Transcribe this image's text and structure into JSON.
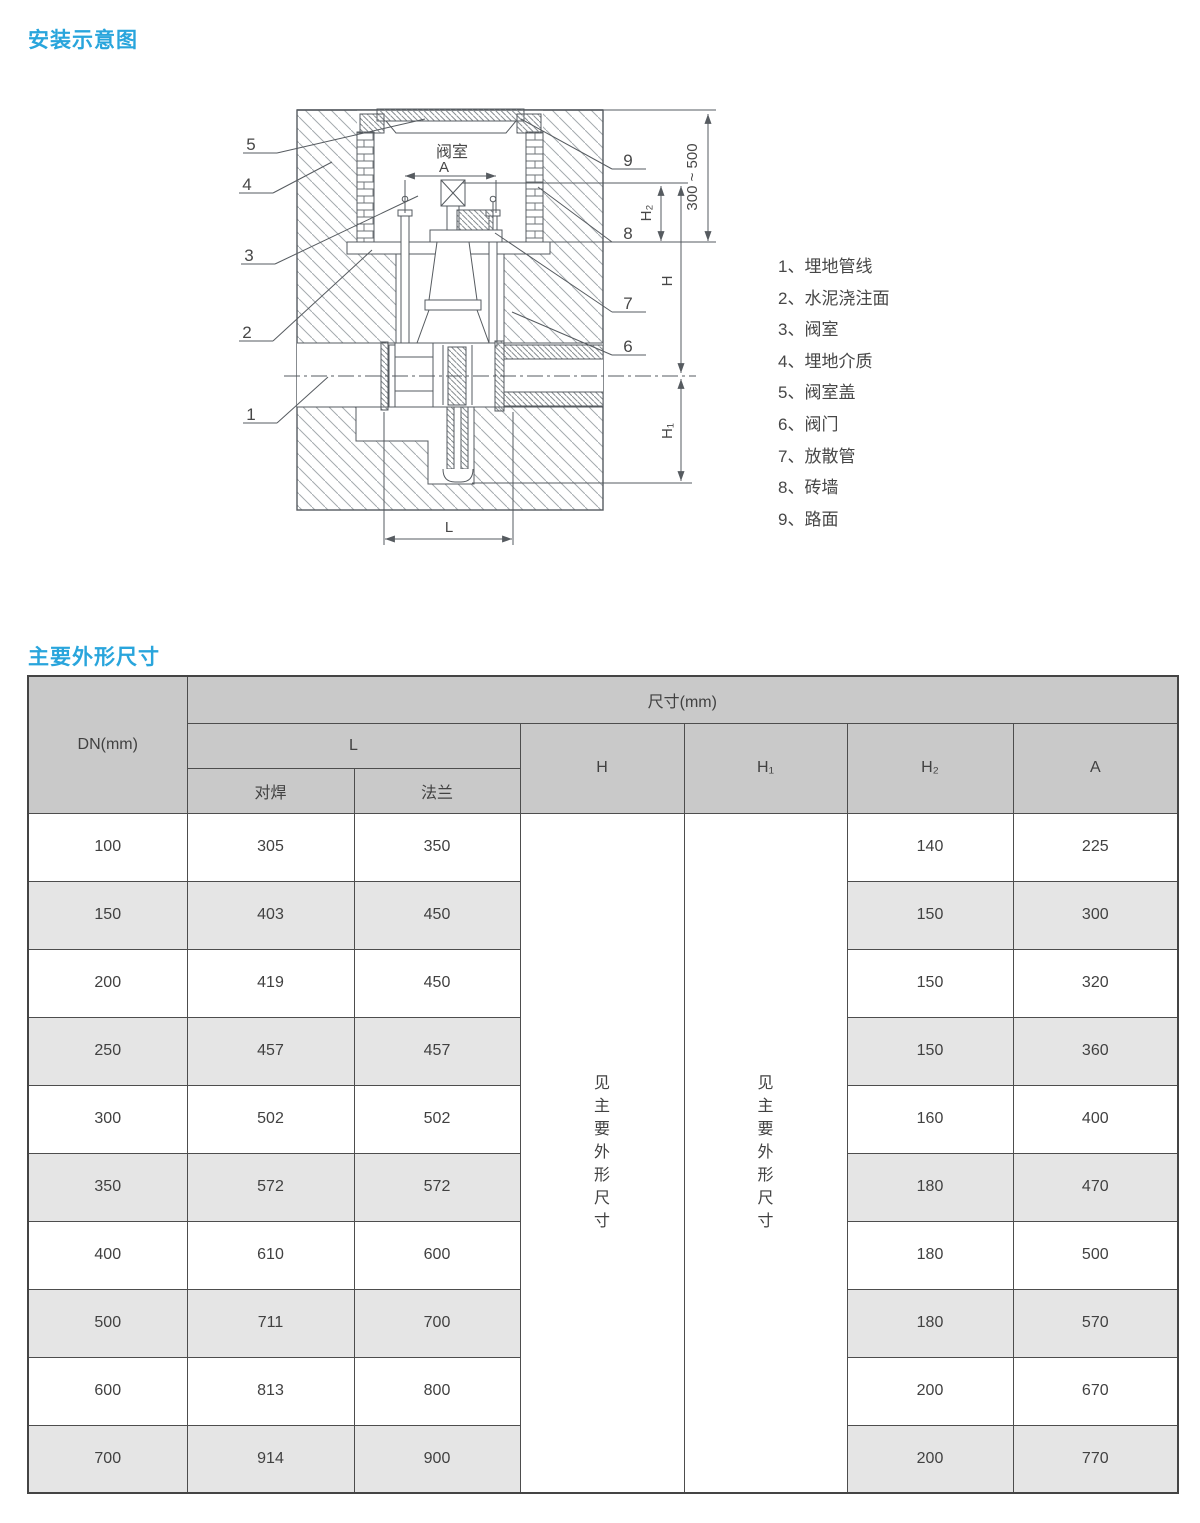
{
  "page": {
    "title_install": "安装示意图",
    "title_dims": "主要外形尺寸"
  },
  "diagram": {
    "chamber_label": "阀室",
    "dims": {
      "a": "A",
      "depth": "300 ~ 500",
      "h": "H",
      "h1": "H₁",
      "h2": "H₂",
      "l": "L"
    },
    "callouts": [
      "1",
      "2",
      "3",
      "4",
      "5",
      "6",
      "7",
      "8",
      "9"
    ],
    "legend": [
      "1、埋地管线",
      "2、水泥浇注面",
      "3、阀室",
      "4、埋地介质",
      "5、阀室盖",
      "6、阀门",
      "7、放散管",
      "8、砖墙",
      "9、路面"
    ]
  },
  "table": {
    "dn_header": "DN(mm)",
    "size_header": "尺寸(mm)",
    "l_header": "L",
    "butt_header": "对焊",
    "flange_header": "法兰",
    "h_header": "H",
    "h1_header": "H₁",
    "h2_header": "H₂",
    "a_header": "A",
    "h_note": "见主要外形尺寸",
    "h1_note": "见主要外形尺寸",
    "rows": [
      {
        "dn": "100",
        "butt": "305",
        "flange": "350",
        "h2": "140",
        "a": "225"
      },
      {
        "dn": "150",
        "butt": "403",
        "flange": "450",
        "h2": "150",
        "a": "300"
      },
      {
        "dn": "200",
        "butt": "419",
        "flange": "450",
        "h2": "150",
        "a": "320"
      },
      {
        "dn": "250",
        "butt": "457",
        "flange": "457",
        "h2": "150",
        "a": "360"
      },
      {
        "dn": "300",
        "butt": "502",
        "flange": "502",
        "h2": "160",
        "a": "400"
      },
      {
        "dn": "350",
        "butt": "572",
        "flange": "572",
        "h2": "180",
        "a": "470"
      },
      {
        "dn": "400",
        "butt": "610",
        "flange": "600",
        "h2": "180",
        "a": "500"
      },
      {
        "dn": "500",
        "butt": "711",
        "flange": "700",
        "h2": "180",
        "a": "570"
      },
      {
        "dn": "600",
        "butt": "813",
        "flange": "800",
        "h2": "200",
        "a": "670"
      },
      {
        "dn": "700",
        "butt": "914",
        "flange": "900",
        "h2": "200",
        "a": "770"
      }
    ]
  }
}
